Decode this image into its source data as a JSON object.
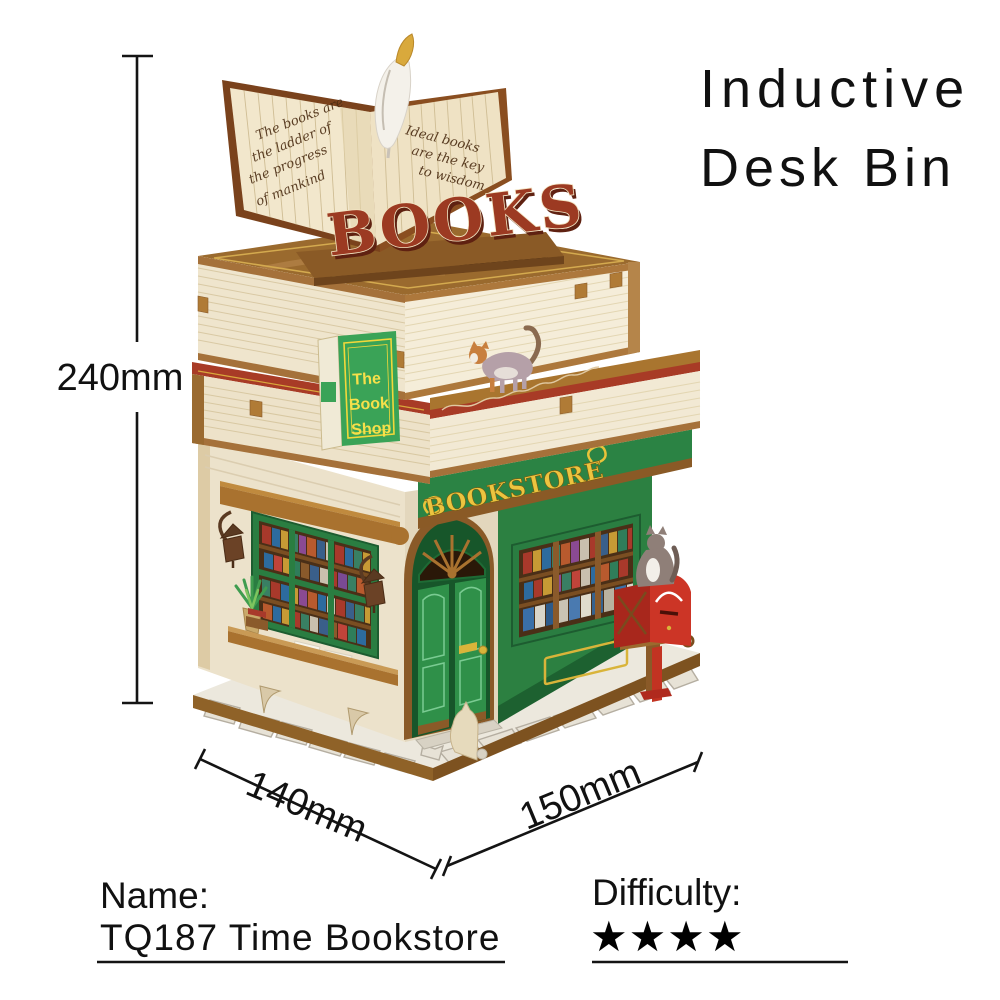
{
  "title": {
    "line1": "Inductive",
    "line2": "Desk Bin"
  },
  "dimensions": {
    "height": "240mm",
    "depth": "140mm",
    "width": "150mm"
  },
  "product": {
    "name_label": "Name:",
    "name_value": "TQ187 Time Bookstore",
    "difficulty_label": "Difficulty:",
    "difficulty_stars": "★★★★"
  },
  "model": {
    "roof_sign": "BOOKS",
    "storefront_sign": "BOOKSTORE",
    "hanging_sign": {
      "line1": "The",
      "line2": "Book",
      "line3": "Shop"
    },
    "open_book": {
      "left_page": [
        "The books are",
        "the ladder of",
        "the progress",
        "of mankind"
      ],
      "right_page": [
        "Ideal books",
        "are the key",
        "to wisdom"
      ]
    },
    "colors": {
      "storefront_green": "#2f9049",
      "sign_gold": "#ecc43f",
      "wood_brown": "#9a6a2e",
      "book_red": "#a83b26",
      "mailbox_red": "#cc3526",
      "page_cream": "#efe5cd"
    }
  }
}
